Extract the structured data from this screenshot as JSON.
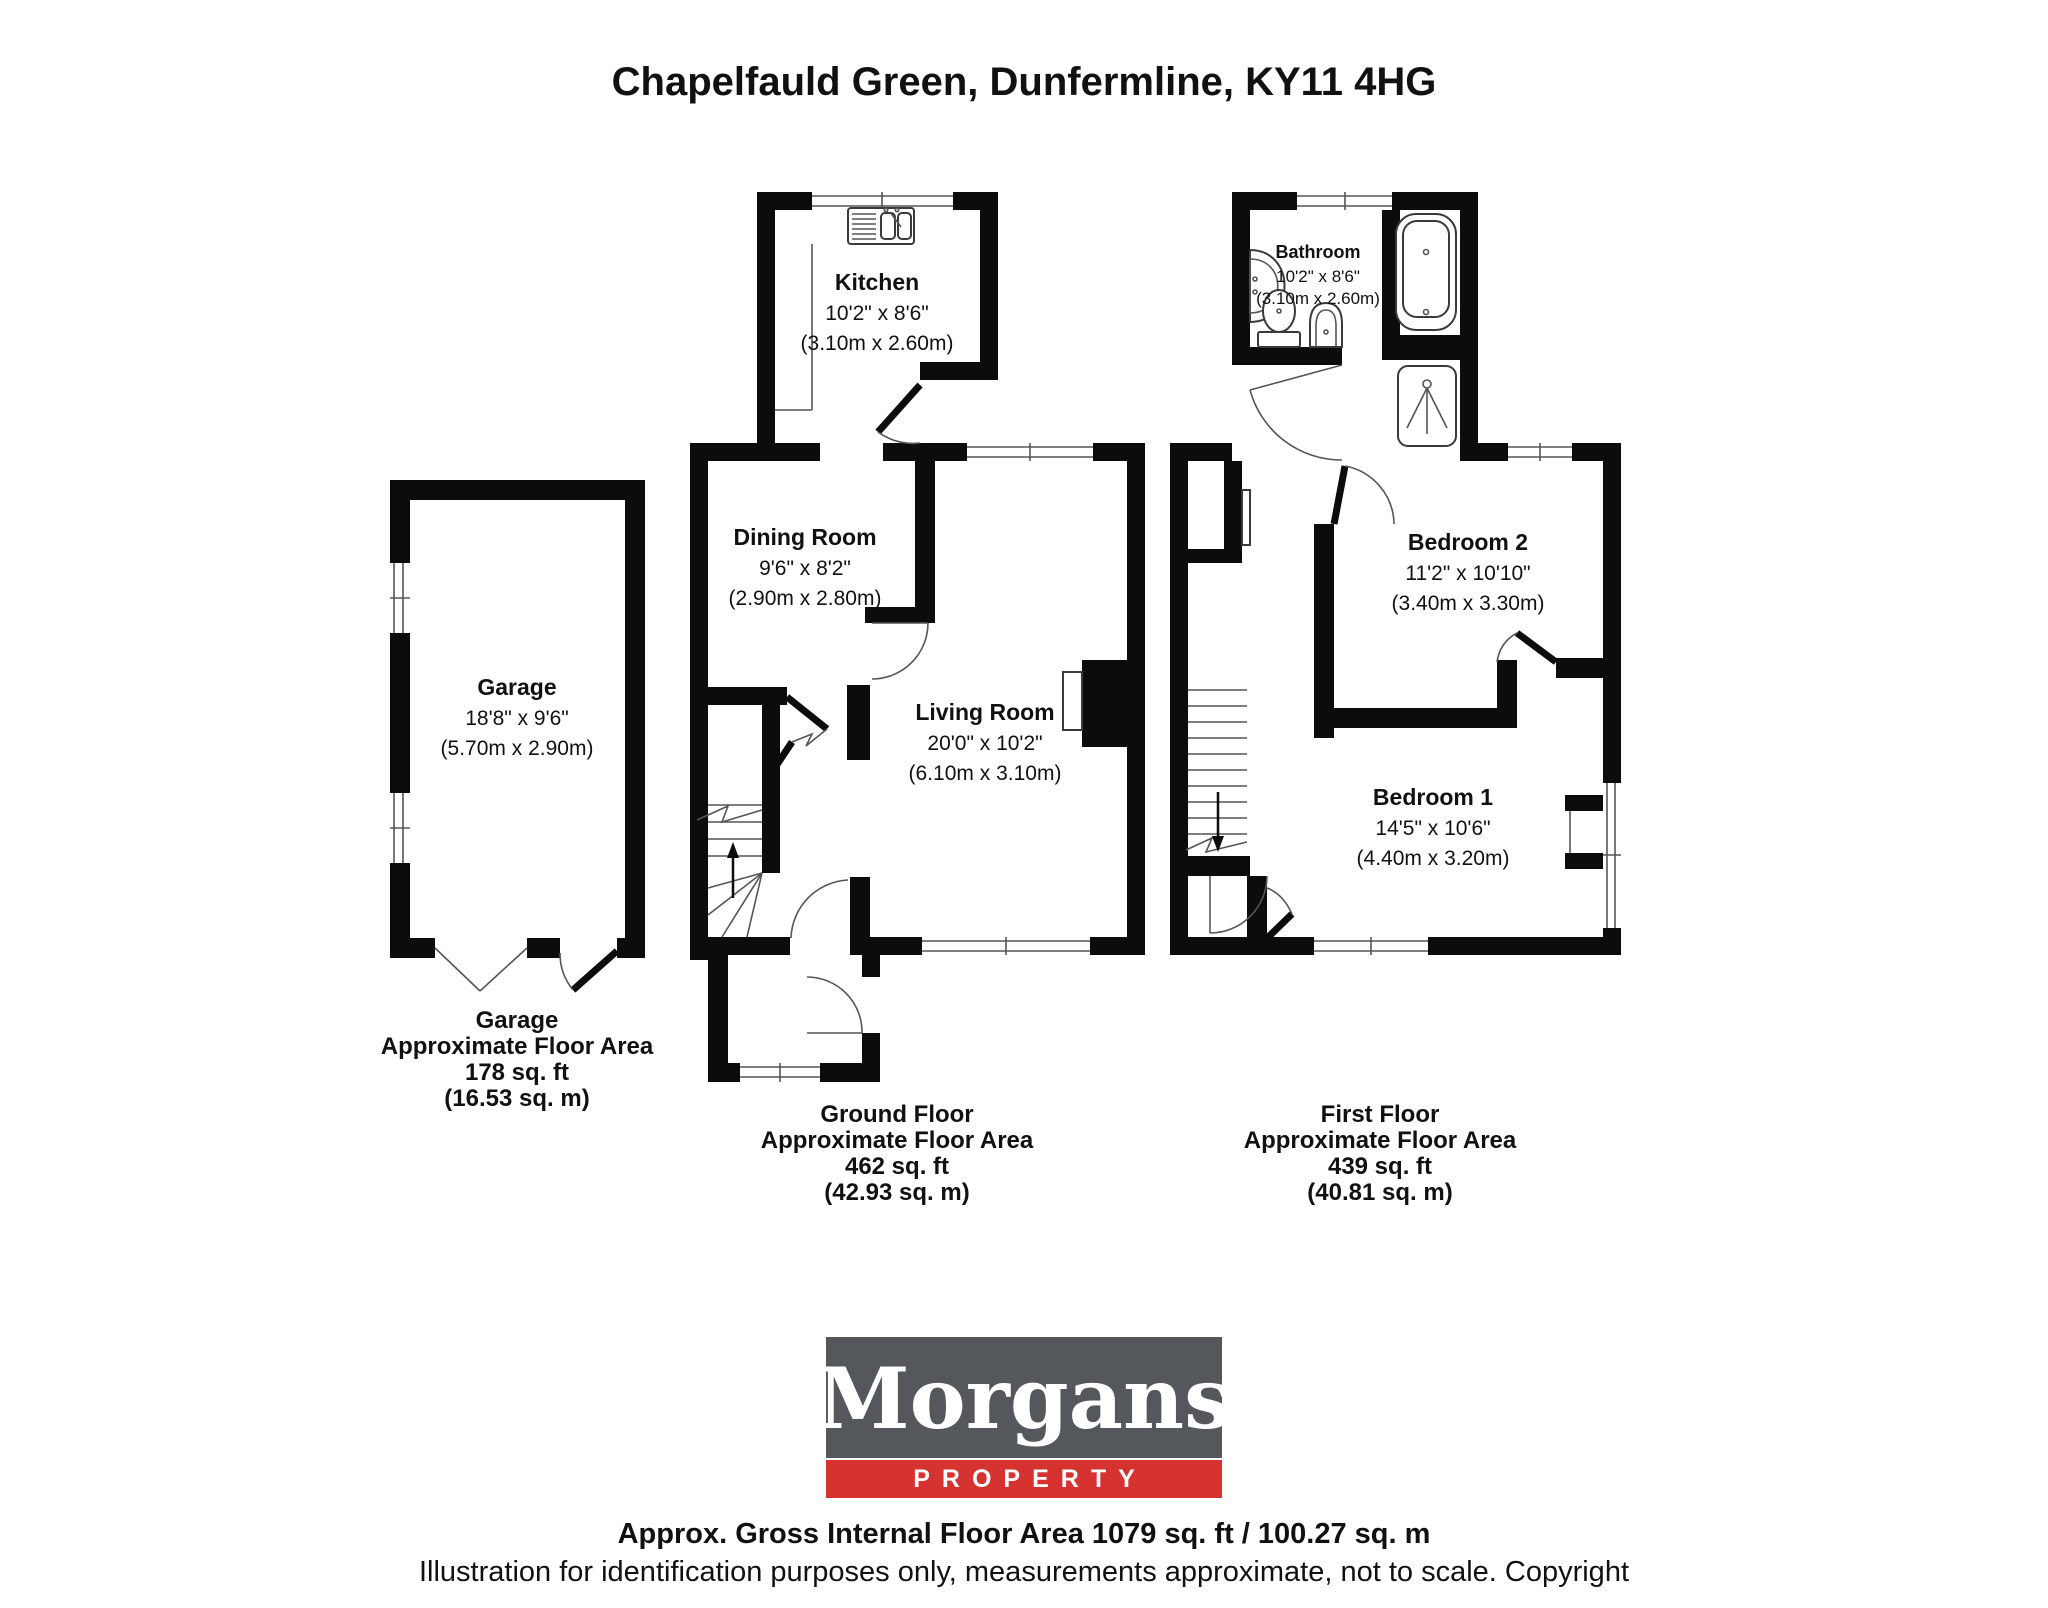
{
  "title": "Chapelfauld Green, Dunfermline, KY11 4HG",
  "rooms": {
    "kitchen": {
      "name": "Kitchen",
      "dims_ft": "10'2\" x 8'6\"",
      "dims_m": "(3.10m x 2.60m)"
    },
    "dining": {
      "name": "Dining Room",
      "dims_ft": "9'6\" x 8'2\"",
      "dims_m": "(2.90m x 2.80m)"
    },
    "living": {
      "name": "Living Room",
      "dims_ft": "20'0\" x 10'2\"",
      "dims_m": "(6.10m x 3.10m)"
    },
    "garage": {
      "name": "Garage",
      "dims_ft": "18'8\" x 9'6\"",
      "dims_m": "(5.70m x 2.90m)"
    },
    "bathroom": {
      "name": "Bathroom",
      "dims_ft": "10'2\" x 8'6\"",
      "dims_m": "(3.10m x 2.60m)"
    },
    "bedroom2": {
      "name": "Bedroom 2",
      "dims_ft": "11'2\" x 10'10\"",
      "dims_m": "(3.40m x 3.30m)"
    },
    "bedroom1": {
      "name": "Bedroom 1",
      "dims_ft": "14'5\" x 10'6\"",
      "dims_m": "(4.40m x 3.20m)"
    }
  },
  "areas": {
    "garage": {
      "line1": "Garage",
      "line2": "Approximate Floor Area",
      "line3": "178 sq. ft",
      "line4": "(16.53 sq. m)"
    },
    "ground": {
      "line1": "Ground Floor",
      "line2": "Approximate Floor Area",
      "line3": "462 sq. ft",
      "line4": "(42.93 sq. m)"
    },
    "first": {
      "line1": "First Floor",
      "line2": "Approximate Floor Area",
      "line3": "439 sq. ft",
      "line4": "(40.81 sq. m)"
    }
  },
  "logo": {
    "brand": "Morgans",
    "division": "PROPERTY",
    "box_color": "#54575b",
    "band_color": "#d63230"
  },
  "footer": {
    "line1": "Approx. Gross Internal Floor Area 1079 sq. ft / 100.27 sq. m",
    "line2": "Illustration for identification purposes only, measurements approximate, not to scale. Copyright"
  }
}
